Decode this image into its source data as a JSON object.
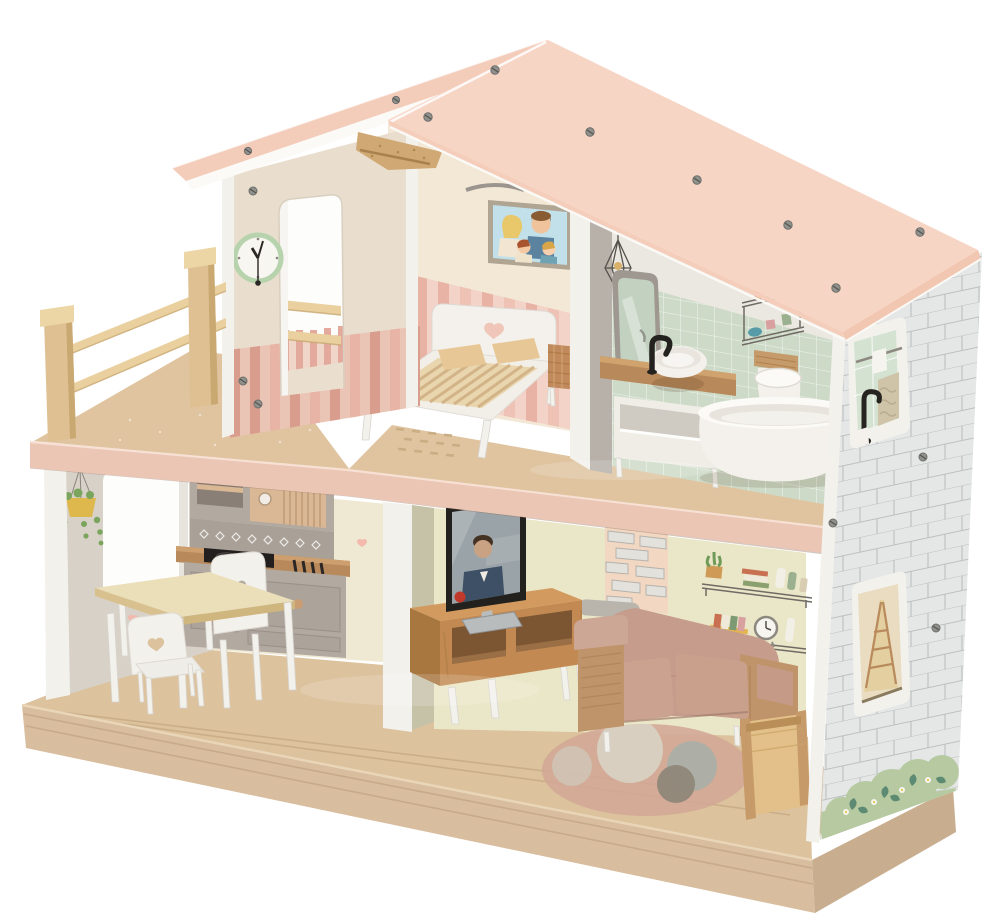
{
  "scene": {
    "subject": "two-story wooden toy dollhouse, three-quarter product view on white background",
    "rooms": [
      "balcony",
      "bedroom",
      "bathroom",
      "kitchen",
      "living-room"
    ],
    "objects": [
      "gable-roof",
      "roof-screws",
      "wooden-ridge-bracket",
      "balcony-railing",
      "wall-clock",
      "doorway",
      "family-portrait",
      "double-bed-heart-headboard",
      "wicker-nightstand",
      "dotted-floor-rug",
      "bathroom-mirror",
      "black-faucet",
      "washbasin-vanity",
      "toilet",
      "bathtub",
      "pendant-lamp-decal",
      "bathroom-shelf-decal",
      "kitchen-wall-unit",
      "microwave",
      "cooktop",
      "kitchen-base-cabinet",
      "dining-table",
      "heart-back-chair",
      "hanging-plant",
      "window-opening",
      "flat-tv",
      "tv-stand",
      "two-seat-sofa",
      "storage-basket",
      "round-rug",
      "brick-decal",
      "shelf-decals",
      "stair-glimpse",
      "brick-side-wall",
      "bush-decals"
    ]
  },
  "colors": {
    "background": "#ffffff",
    "roof_pink": "#f7d5c5",
    "roof_strip": "#f3ccba",
    "roof_edge_pink": "#f2c7b2",
    "bracket_wood": "#cfa873",
    "gable_beige": "#e9decd",
    "gable_stripe": "#d99d8d",
    "bedroom_cream": "#f3e7d6",
    "bedroom_stripe": "#e8b2a4",
    "bath_tile_green": "#cddac7",
    "partition_gray": "#b7b1a9",
    "white_trim": "#f2f0ea",
    "exterior_gray": "#e4e7e6",
    "brick_line": "#bcc0bf",
    "bush_green": "#b6c9a0",
    "bush_leaf": "#5d8a72",
    "kitchen_cream": "#efe8d3",
    "left_wall_gray": "#d7d1c8",
    "living_sage": "#eae6c8",
    "sage_strip": "#c6c2a8",
    "unit_gray": "#b2a9a1",
    "microwave_tan": "#dab795",
    "counter_wood": "#b8895a",
    "table_cream": "#ebdfba",
    "chair_white": "#f3f1ec",
    "tv_frame": "#23211e",
    "tv_screen": "#9aa3a8",
    "stand_wood": "#c28a52",
    "sofa_mauve": "#c69c8c",
    "sofa_cushion": "#cba28f",
    "arm_wood": "#c0946a",
    "basket_tan": "#e3c089",
    "rug_pink": "#d2a795",
    "rug_cream": "#d8d1c3",
    "rug_gray": "#a9afa7",
    "rug_taupe": "#8d8578",
    "floor_wood": "#dcc29d",
    "slab_pink": "#ebc6b5",
    "base_wood": "#d8bd9e",
    "base_side": "#c8ad8e",
    "rail_wood": "#e9d09e",
    "post_wood": "#dfc092",
    "clock_ring": "#b7d3ad",
    "heart_pink": "#f2b9ac",
    "plant_green": "#7ba55c",
    "pot_yellow": "#dfb84d",
    "picture_sky": "#c2e0ea",
    "fixture_white": "#f4f1ec",
    "faucet_black": "#24221f",
    "brick_decal_bg": "#f2d8c2"
  }
}
